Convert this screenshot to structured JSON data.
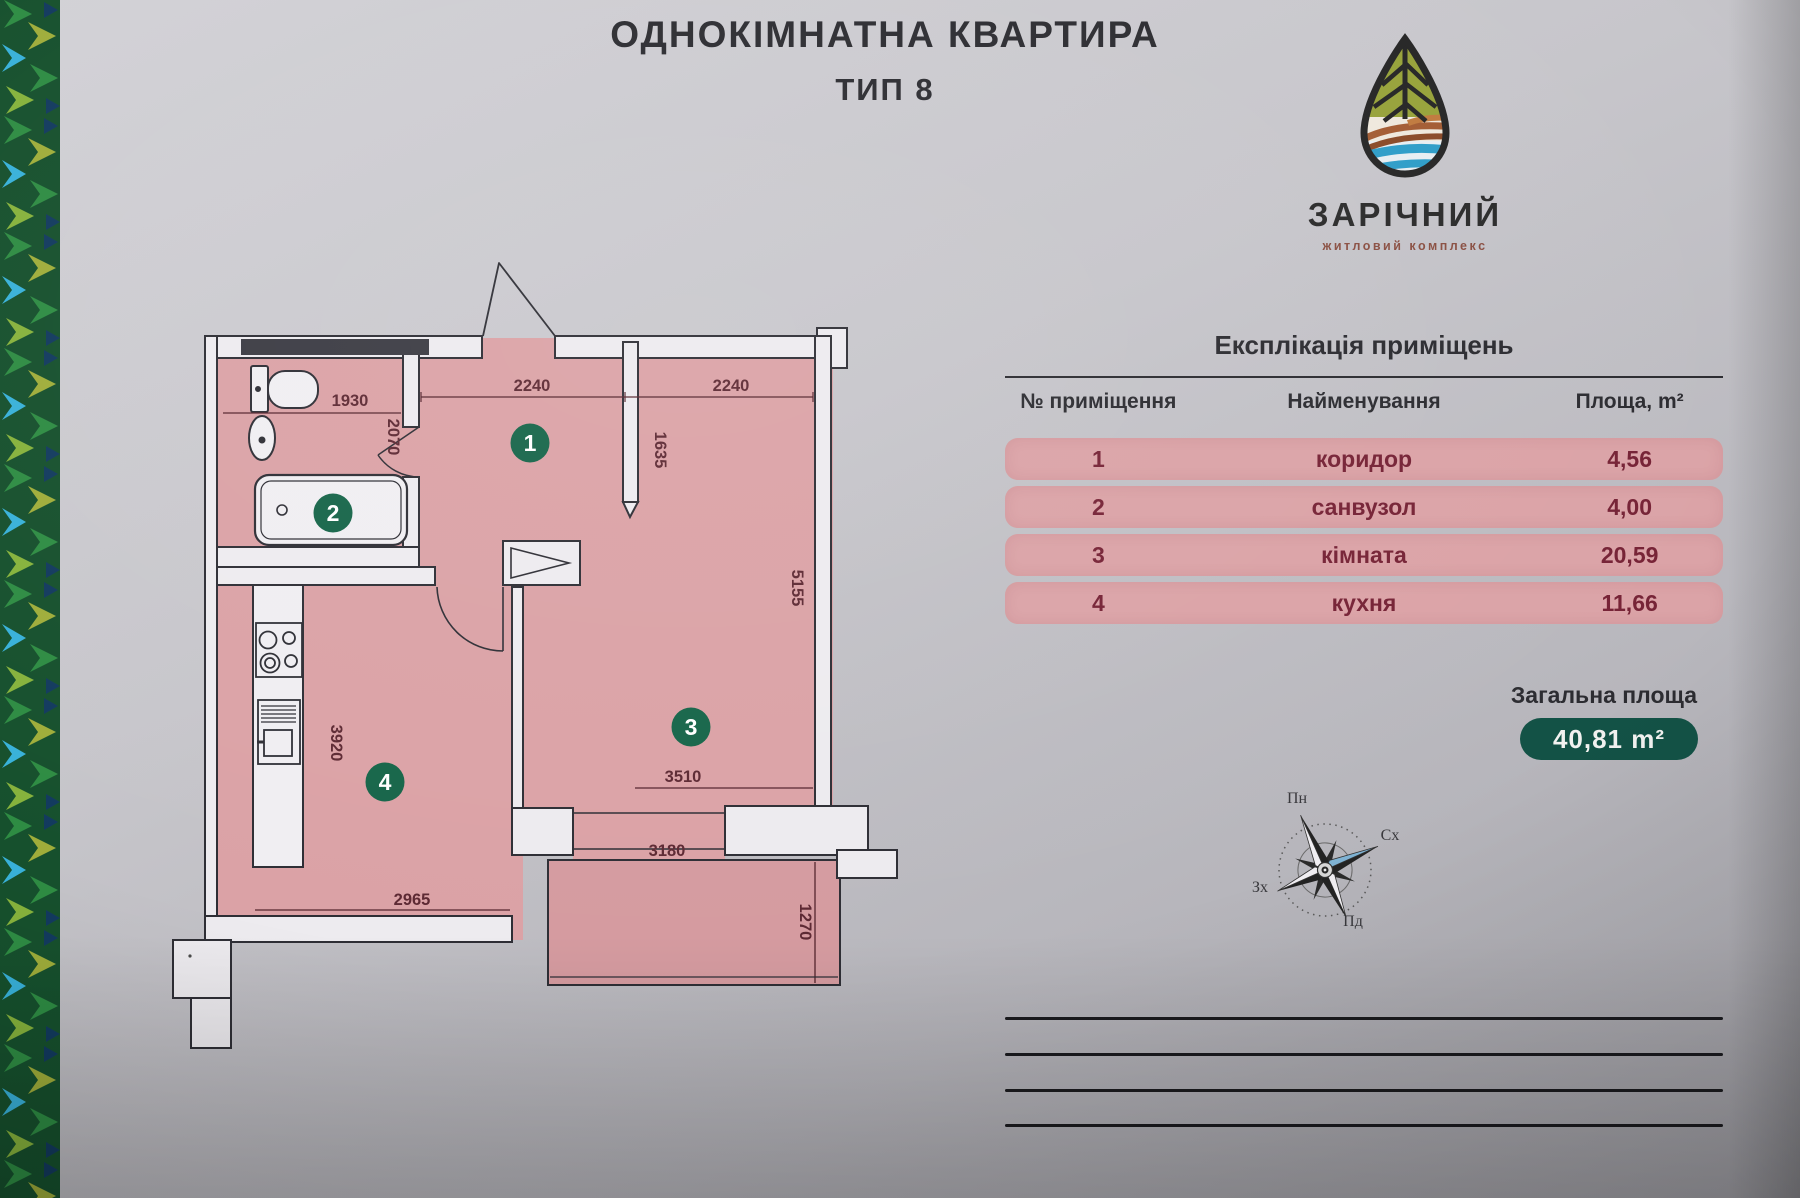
{
  "header": {
    "title_line1": "ОДНОКІМНАТНА КВАРТИРА",
    "title_line2": "ТИП 8"
  },
  "logo": {
    "name": "ЗАРІЧНИЙ",
    "subtitle": "житловий комплекс"
  },
  "explication": {
    "title": "Експлікація приміщень",
    "columns": [
      "№ приміщення",
      "Найменування",
      "Площа, m²"
    ],
    "rows": [
      {
        "num": "1",
        "name": "коридор",
        "area": "4,56"
      },
      {
        "num": "2",
        "name": "санвузол",
        "area": "4,00"
      },
      {
        "num": "3",
        "name": "кімната",
        "area": "20,59"
      },
      {
        "num": "4",
        "name": "кухня",
        "area": "11,66"
      }
    ],
    "total_label": "Загальна площа",
    "total_value": "40,81 m²"
  },
  "floorplan": {
    "badges": {
      "corridor": "1",
      "bathroom": "2",
      "room": "3",
      "kitchen": "4"
    },
    "dims": {
      "d1930": "1930",
      "d2070": "2070",
      "d2240a": "2240",
      "d2240b": "2240",
      "d1635": "1635",
      "d5155": "5155",
      "d3920": "3920",
      "d3510": "3510",
      "d3180": "3180",
      "d2965": "2965",
      "d1270": "1270"
    }
  },
  "compass": {
    "n": "Пн",
    "e": "Сх",
    "w": "Зх",
    "s": "Пд"
  },
  "colors": {
    "row_pink": "#dba3a7",
    "plan_pink": "#dba2a6",
    "badge_green": "#166549",
    "total_badge": "#135246",
    "logo_green": "#97a23a",
    "logo_brown": "#a35c33",
    "logo_blue": "#2e9dc8"
  }
}
